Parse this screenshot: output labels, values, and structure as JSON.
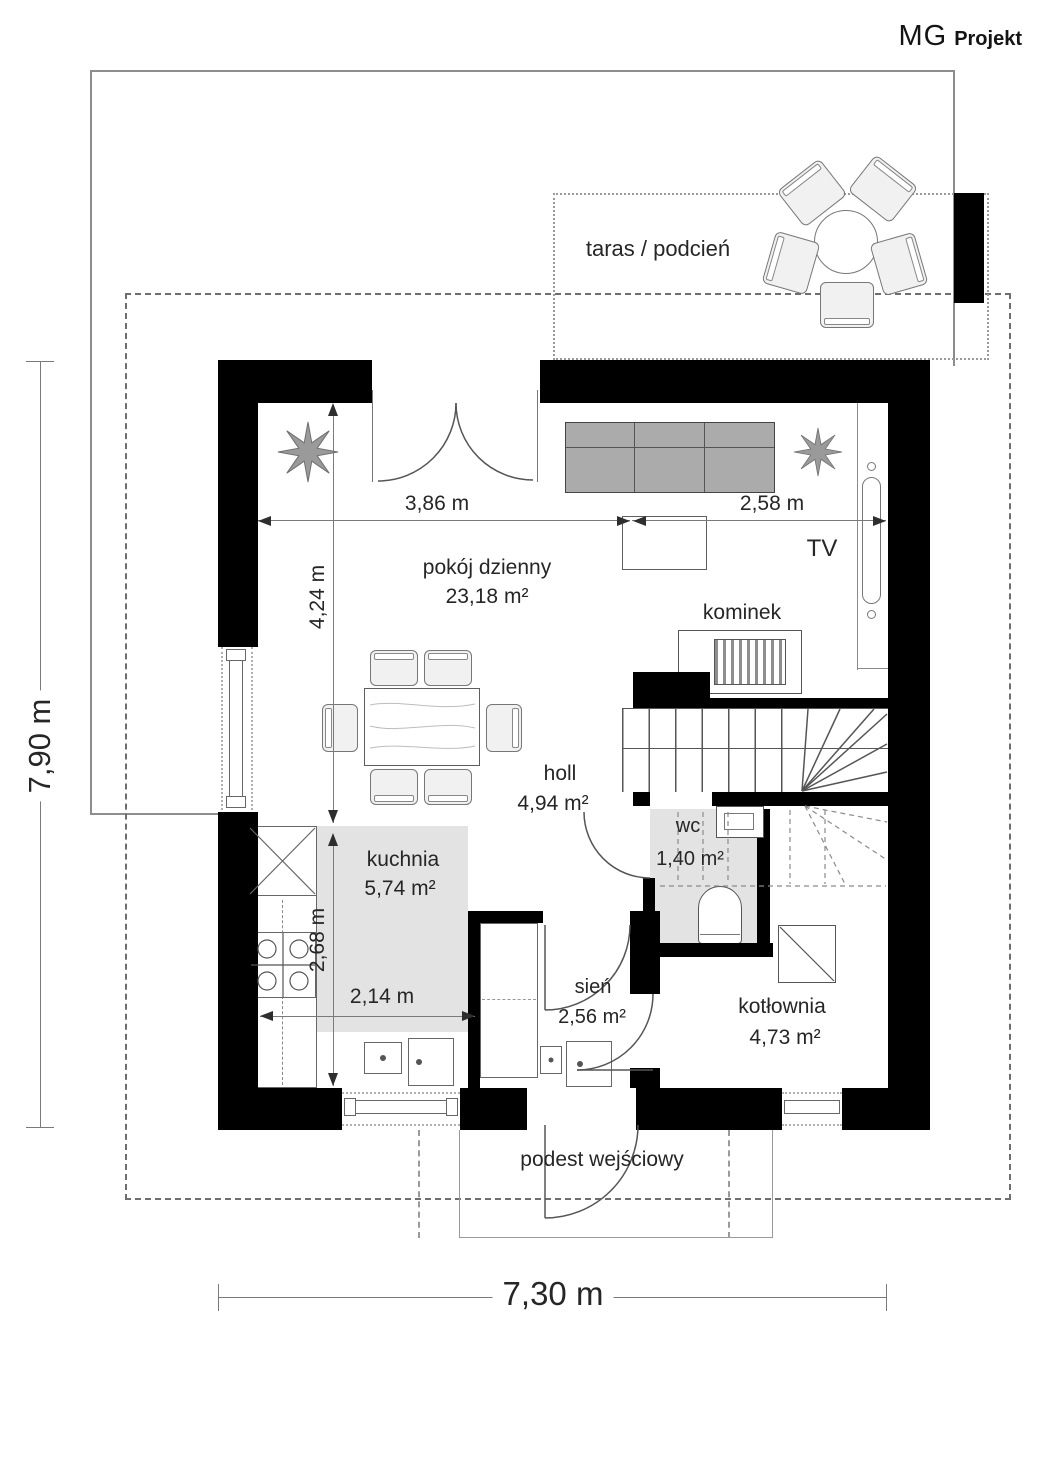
{
  "brand": {
    "primary": "MG",
    "secondary": "Projekt"
  },
  "plan": {
    "rooms": {
      "taras": {
        "label": "taras / podcień"
      },
      "pokoj": {
        "label": "pokój dzienny",
        "area": "23,18 m²"
      },
      "holl": {
        "label": "holl",
        "area": "4,94 m²"
      },
      "wc": {
        "label": "wc",
        "area": "1,40 m²"
      },
      "kuchnia": {
        "label": "kuchnia",
        "area": "5,74 m²"
      },
      "sien": {
        "label": "sień",
        "area": "2,56 m²"
      },
      "kotlownia": {
        "label": "kotłownia",
        "area": "4,73 m²"
      },
      "podest": {
        "label": "podest wejściowy"
      }
    },
    "features": {
      "kominek": "kominek",
      "tv": "TV"
    },
    "dimensions": {
      "overall_width": "7,30 m",
      "overall_depth": "7,90 m",
      "living_width_left": "3,86 m",
      "living_width_right": "2,58 m",
      "living_depth": "4,24 m",
      "kitchen_depth": "2,68 m",
      "kitchen_width": "2,14 m"
    },
    "colors": {
      "wall": "#000000",
      "room_accent": "#e3e3e3",
      "linework": "#666666"
    }
  }
}
